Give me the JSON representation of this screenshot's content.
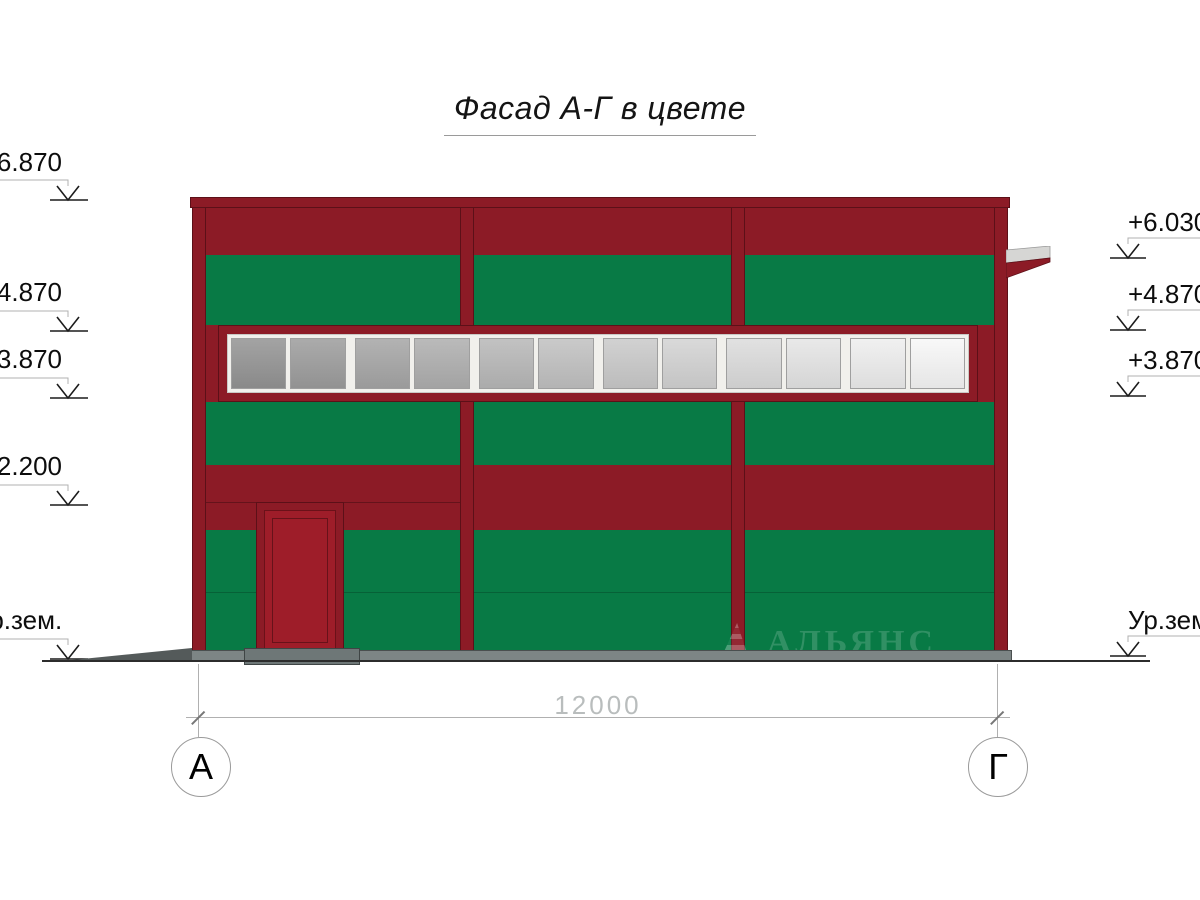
{
  "title": "Фасад А-Г в цвете",
  "marks": {
    "left": [
      {
        "label": "+6.870"
      },
      {
        "label": "+4.870"
      },
      {
        "label": "+3.870"
      },
      {
        "label": "+2.200"
      },
      {
        "label": "Ур.зем."
      }
    ],
    "right": [
      {
        "label": "+6.030"
      },
      {
        "label": "+4.870"
      },
      {
        "label": "+3.870"
      },
      {
        "label": "Ур.зем."
      }
    ]
  },
  "dimension": {
    "length": "12000"
  },
  "axes": {
    "left": "А",
    "right": "Г"
  },
  "logo": {
    "name": "АЛЬЯНС",
    "tagline": "строительная компания"
  },
  "window": {
    "pane_count": 12,
    "pane_color_start": "#949494",
    "pane_color_end": "#f7f7f7"
  },
  "colors": {
    "facade_red": "#8C1B26",
    "panel_green": "#087A45",
    "door_red": "#9E1D29",
    "outline_dark": "#5C1018",
    "canopy_gray": "#D6D6D4",
    "base_gray": "#7D8585",
    "dim_gray": "#B9BDBD"
  }
}
